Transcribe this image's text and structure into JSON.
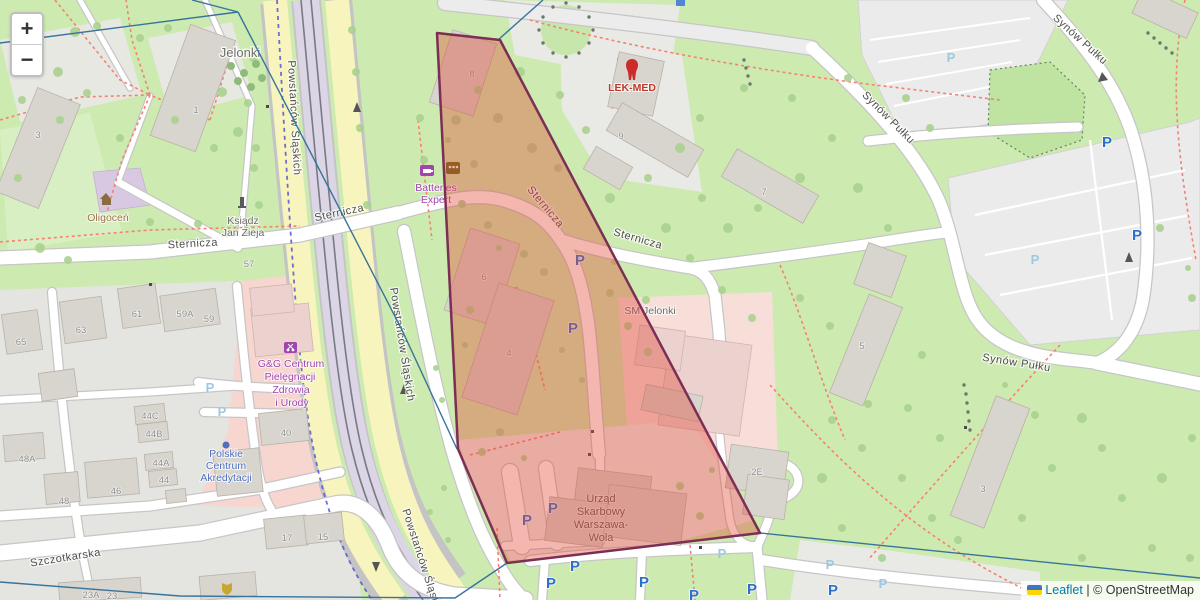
{
  "ui": {
    "zoom_in": "+",
    "zoom_out": "−",
    "attribution": {
      "leaflet": "Leaflet",
      "separator": " | ",
      "osm": "© OpenStreetMap",
      "flag_top": "#3C75C4",
      "flag_bottom": "#FFD500"
    }
  },
  "streets": {
    "sternicza": "Sternicza",
    "powstancow": "Powstańców Śląskich",
    "synow": "Synów Pułku",
    "szczotkarska": "Szczotkarska"
  },
  "places": {
    "jelonki": "Jelonki",
    "oligocen": "Oligoceń",
    "ksiadz_line1": "Ksiądz",
    "ksiadz_line2": "Jan Zieja",
    "sm_jelonki": "SM Jelonki"
  },
  "pois": {
    "lek_med": "LEK-MED",
    "batteries_line1": "Batteries",
    "batteries_line2": "Expert",
    "gg": [
      "G&G Centrum",
      "Pielęgnacji",
      "Zdrowia",
      "i Urody"
    ],
    "pca": [
      "Polskie",
      "Centrum",
      "Akredytacji"
    ],
    "urzad": [
      "Urząd",
      "Skarbowy",
      "Warszawa-",
      "Wola"
    ]
  },
  "parking": {
    "glyph": "P"
  },
  "house_numbers": [
    {
      "t": "3",
      "x": 38,
      "y": 138
    },
    {
      "t": "1",
      "x": 196,
      "y": 113
    },
    {
      "t": "8",
      "x": 472,
      "y": 77
    },
    {
      "t": "9",
      "x": 621,
      "y": 139
    },
    {
      "t": "7",
      "x": 764,
      "y": 195
    },
    {
      "t": "6",
      "x": 484,
      "y": 280
    },
    {
      "t": "4",
      "x": 509,
      "y": 356
    },
    {
      "t": "5",
      "x": 862,
      "y": 349
    },
    {
      "t": "2E",
      "x": 757,
      "y": 475
    },
    {
      "t": "3",
      "x": 983,
      "y": 492
    },
    {
      "t": "65",
      "x": 21,
      "y": 345
    },
    {
      "t": "63",
      "x": 81,
      "y": 333
    },
    {
      "t": "61",
      "x": 137,
      "y": 317
    },
    {
      "t": "59A",
      "x": 185,
      "y": 317
    },
    {
      "t": "59",
      "x": 209,
      "y": 322
    },
    {
      "t": "44C",
      "x": 150,
      "y": 419
    },
    {
      "t": "44B",
      "x": 154,
      "y": 437
    },
    {
      "t": "44A",
      "x": 161,
      "y": 466
    },
    {
      "t": "44",
      "x": 164,
      "y": 483
    },
    {
      "t": "48A",
      "x": 27,
      "y": 462
    },
    {
      "t": "48",
      "x": 64,
      "y": 504
    },
    {
      "t": "46",
      "x": 116,
      "y": 494
    },
    {
      "t": "40",
      "x": 286,
      "y": 436
    },
    {
      "t": "17",
      "x": 287,
      "y": 541
    },
    {
      "t": "15",
      "x": 323,
      "y": 540
    },
    {
      "t": "57",
      "x": 249,
      "y": 267
    },
    {
      "t": "23A",
      "x": 91,
      "y": 598
    },
    {
      "t": "23",
      "x": 112,
      "y": 599
    }
  ],
  "parking_icons": [
    {
      "style": "bold",
      "x": 580,
      "y": 265
    },
    {
      "style": "bold",
      "x": 573,
      "y": 333
    },
    {
      "style": "bold",
      "x": 527,
      "y": 525
    },
    {
      "style": "bold",
      "x": 553,
      "y": 513
    },
    {
      "style": "bold",
      "x": 575,
      "y": 571
    },
    {
      "style": "bold",
      "x": 551,
      "y": 588
    },
    {
      "style": "bold",
      "x": 644,
      "y": 587
    },
    {
      "style": "bold",
      "x": 752,
      "y": 594
    },
    {
      "style": "bold",
      "x": 694,
      "y": 600
    },
    {
      "style": "bold",
      "x": 833,
      "y": 595
    },
    {
      "style": "bold",
      "x": 1107,
      "y": 147
    },
    {
      "style": "bold",
      "x": 1137,
      "y": 240
    },
    {
      "style": "light",
      "x": 722,
      "y": 558
    },
    {
      "style": "light",
      "x": 830,
      "y": 569
    },
    {
      "style": "light",
      "x": 951,
      "y": 62
    },
    {
      "style": "light",
      "x": 1035,
      "y": 264
    },
    {
      "style": "light",
      "x": 210,
      "y": 392
    },
    {
      "style": "light",
      "x": 222,
      "y": 416
    },
    {
      "style": "light",
      "x": 883,
      "y": 588
    }
  ],
  "overlay": {
    "points": "437,33 500,40 760,533 507,563 458,449",
    "fill": "rgba(226,75,58,0.40)",
    "stroke": "#7c2f55"
  },
  "boundaries": {
    "b1": "0,43 238,12",
    "b2": "192,0 238,12",
    "b3": "238,12 300,132 402,330 457,449",
    "b4": "543,0 498,40",
    "b5": "760,533 1200,578",
    "b6": "0,582 180,596 455,598 507,563"
  },
  "colors": {
    "boundary": "#37749c",
    "route_dashed": "#5b55cf",
    "grass": "#cdebb0"
  }
}
